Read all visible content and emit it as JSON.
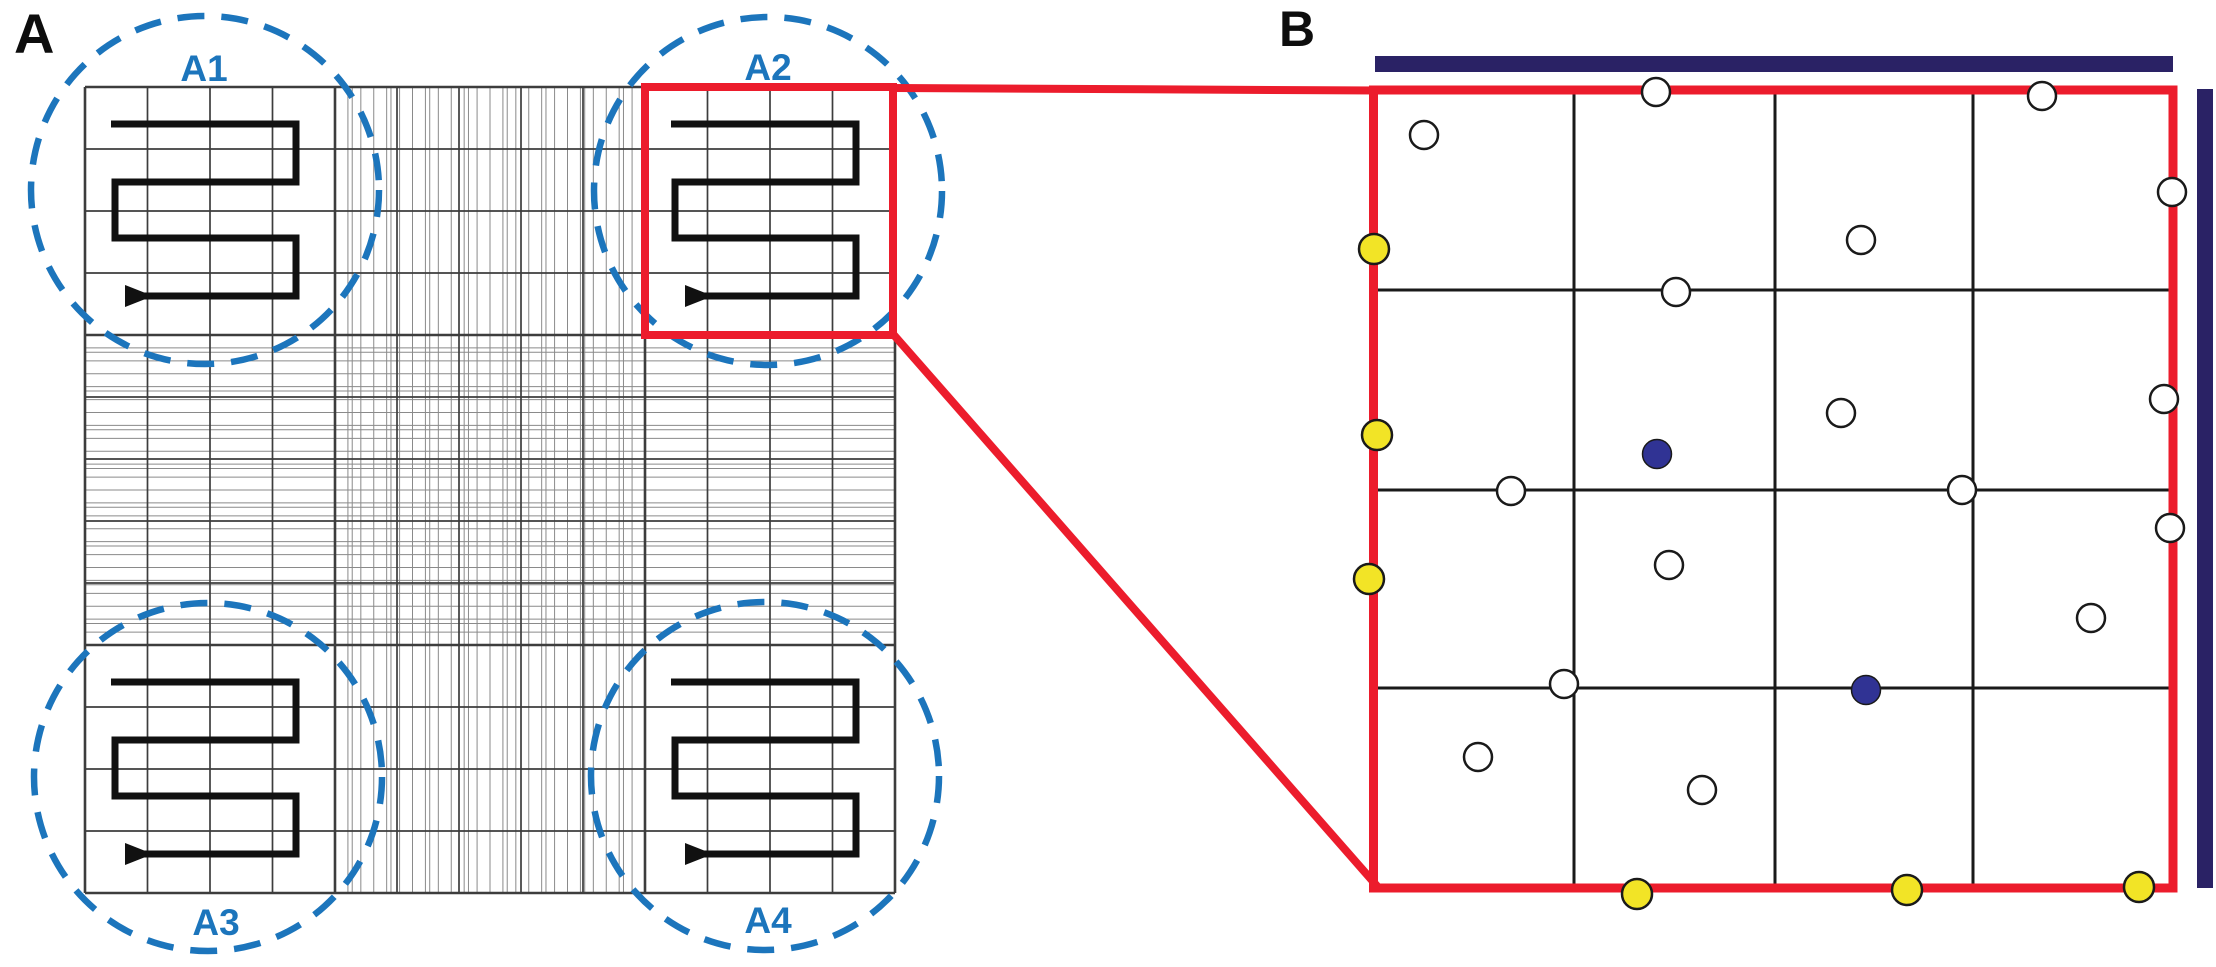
{
  "figure": {
    "panel_a_label": "A",
    "panel_b_label": "B",
    "corner_region_labels": [
      "A1",
      "A2",
      "A3",
      "A4"
    ]
  },
  "panel_a": {
    "region_circle_color": "#1c75bc",
    "counting_path_color": "#111111"
  },
  "panel_b": {
    "cells": {
      "open": [
        [
          1424,
          135
        ],
        [
          1656,
          92
        ],
        [
          2042,
          96
        ],
        [
          2172,
          192
        ],
        [
          1861,
          240
        ],
        [
          1676,
          292
        ],
        [
          2164,
          399
        ],
        [
          1841,
          413
        ],
        [
          1511,
          491
        ],
        [
          1962,
          490
        ],
        [
          2170,
          528
        ],
        [
          1669,
          565
        ],
        [
          2091,
          618
        ],
        [
          1564,
          684
        ],
        [
          1478,
          757
        ],
        [
          1702,
          790
        ]
      ],
      "yellow": [
        [
          1374,
          249
        ],
        [
          1377,
          435
        ],
        [
          1369,
          579
        ],
        [
          1637,
          894
        ],
        [
          1907,
          890
        ],
        [
          2139,
          887
        ]
      ],
      "navy": [
        [
          1657,
          454
        ],
        [
          1866,
          690
        ]
      ]
    }
  },
  "colors": {
    "accent_red": "#EC1C2C",
    "accent_blue": "#1C75BC",
    "navy_bar": "#2A2265",
    "navy_cell": "#303394",
    "yellow_cell": "#F2E426",
    "cell_outline": "#1a1a1a",
    "grid_coarse": "#3d3d3d",
    "grid_fine": "#8a8a8a",
    "panel_b_grid": "#1a1a1a",
    "path_black": "#111111"
  }
}
